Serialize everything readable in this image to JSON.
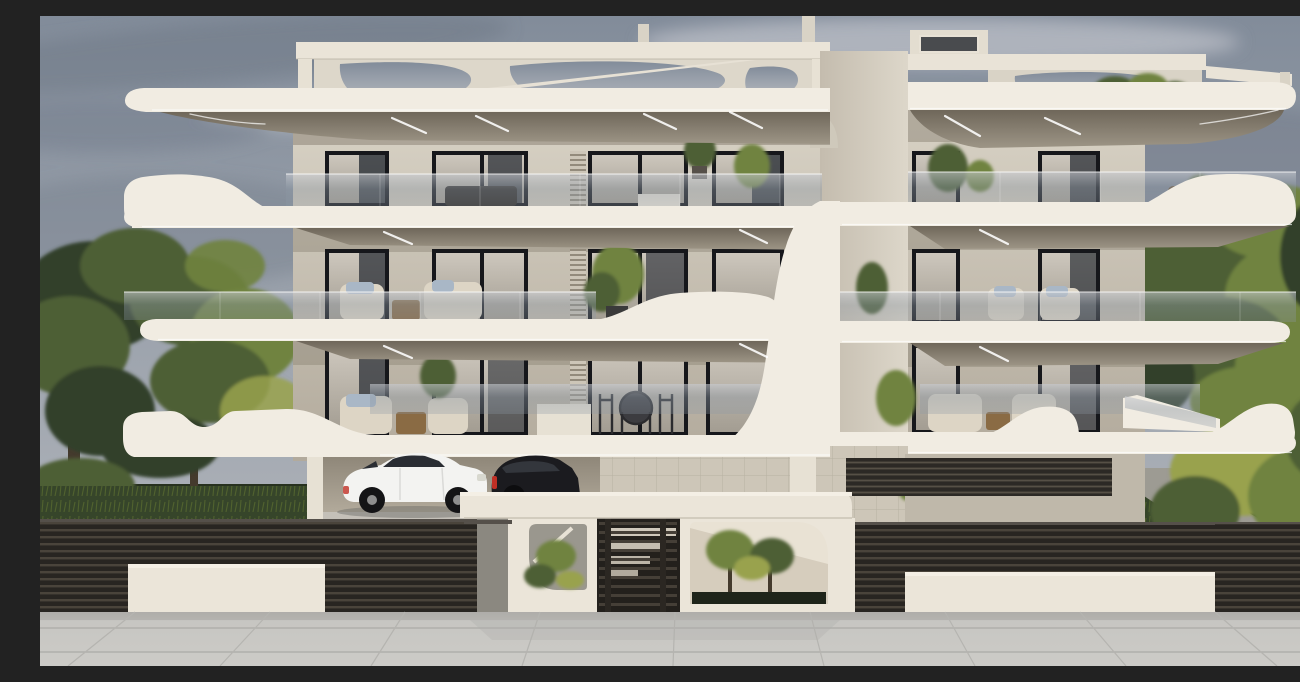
{
  "meta": {
    "title": "Exterior 3D render of a modern three-storey apartment building on an overcast day",
    "media_type": "architectural visualization",
    "sky": "overcast, gray-blue clouds"
  },
  "scene": {
    "building": {
      "storeys_visible": 3,
      "style": "contemporary facade with curved white wave parapets, cantilevered slabs and glass balustrades",
      "facade_color_name": "cream / off-white",
      "roof": "flat roof with white pergola beams, curved cut-out panels and a stair bulkhead",
      "left_wing_window_bays_per_floor": 4,
      "right_wing_window_bays_per_floor": 2,
      "balcony_features": [
        "glass railings",
        "recessed LED soffit lights",
        "potted plants",
        "outdoor furniture"
      ],
      "ground_level": [
        "covered carport",
        "terrace with dining set",
        "terrace with cream lounge sofas",
        "louvered basement vents",
        "side stair"
      ]
    },
    "vehicles": [
      {
        "type": "SUV",
        "color": "white",
        "location": "carport"
      },
      {
        "type": "compact car",
        "color": "black",
        "location": "carport, partially hidden"
      }
    ],
    "foreground": {
      "fence": "dark horizontal-slat fence left and right",
      "entrance": "white street wall with slatted gate, rounded cut-out openings and planting",
      "white_low_panels": 2,
      "sidewalk": "large light-gray pavement tiles"
    },
    "landscape": {
      "left": [
        "tall trees",
        "lawn",
        "concrete garden path",
        "hedge"
      ],
      "right": [
        "large tree",
        "yellow-green shrubs",
        "lawn",
        "garden path"
      ]
    }
  },
  "palette": {
    "sky_top": "#828c9a",
    "sky_mid": "#9ba2ac",
    "sky_low": "#b6b9be",
    "cloud_light": "#c9ccd2",
    "cloud_dark": "#6e7886",
    "cream": "#e7e1d4",
    "fascia": "#f1ece2",
    "cream_dim": "#d9d3c6",
    "soffit_dark": "#6f675a",
    "soffit_light": "#9d9586",
    "wall_lit": "#d8d2c5",
    "wall_shadow": "#b2aa9c",
    "window_frame": "#16171b",
    "window_glass": "#34383e",
    "curtain_light": "#cdc7bd",
    "curtain_dark": "#a39d92",
    "balustrade_glass": "#8d98a4",
    "white_panel": "#ebe5d9",
    "fence_dark": "#282521",
    "fence_slat": "#4a443b",
    "path_gray": "#9d9b93",
    "walk_tile": "#c7c6c2",
    "walk_line": "#b0afab",
    "green_dark": "#32402a",
    "green_mid": "#4e5e34",
    "green_light": "#70833f",
    "green_yellow": "#99a24e",
    "grass_dark": "#36452a",
    "grass_light": "#57692f",
    "trunk": "#443a2d",
    "car_white": "#f3f3f1",
    "car_black": "#1b1b1f",
    "tail_light_red": "#c03026",
    "sofa_cream": "#ddd5c5",
    "wood": "#8a6b44"
  }
}
